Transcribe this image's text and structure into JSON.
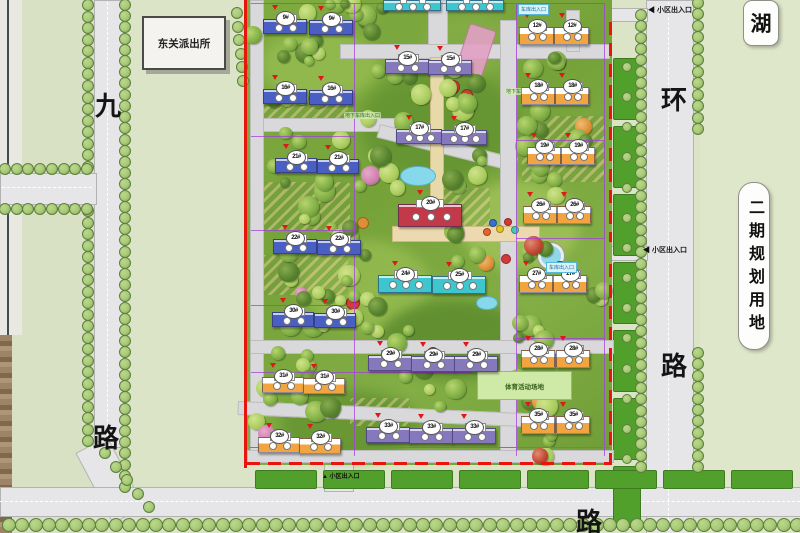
{
  "map_labels": {
    "police_station": "东关派出所",
    "lake": "湖",
    "phase2_vertical": "二期规划用地",
    "road_left_top": "九",
    "road_left_bottom": "路",
    "road_right_top": "环",
    "road_right_bottom": "路",
    "road_bottom": "路",
    "sports_field": "体育活动场地",
    "garage_entrance": "车库出入口",
    "underground_garage": "地下车库出入口",
    "community_entrance": "小区出入口"
  },
  "entrances": [
    {
      "x": 648,
      "y": 5,
      "arrow": "◀"
    },
    {
      "x": 643,
      "y": 245,
      "arrow": "◀"
    },
    {
      "x": 322,
      "y": 471,
      "arrow": "▲"
    }
  ],
  "garage_labels": [
    {
      "x": 518,
      "y": 4
    },
    {
      "x": 546,
      "y": 262
    }
  ],
  "underground_labels": [
    {
      "x": 344,
      "y": 112
    },
    {
      "x": 505,
      "y": 88
    }
  ],
  "buildings": [
    {
      "label": "9#",
      "color": "blue",
      "x": 263,
      "y": 19,
      "w": 42,
      "h": 13
    },
    {
      "label": "9#",
      "color": "blue",
      "x": 309,
      "y": 20,
      "w": 42,
      "h": 13
    },
    {
      "label": "16#",
      "color": "blue",
      "x": 263,
      "y": 89,
      "w": 42,
      "h": 13
    },
    {
      "label": "16#",
      "color": "blue",
      "x": 309,
      "y": 90,
      "w": 42,
      "h": 13
    },
    {
      "label": "21#",
      "color": "blue",
      "x": 275,
      "y": 158,
      "w": 40,
      "h": 13
    },
    {
      "label": "21#",
      "color": "blue",
      "x": 317,
      "y": 159,
      "w": 40,
      "h": 13
    },
    {
      "label": "22#",
      "color": "blue",
      "x": 273,
      "y": 239,
      "w": 42,
      "h": 13
    },
    {
      "label": "22#",
      "color": "blue",
      "x": 317,
      "y": 240,
      "w": 42,
      "h": 13
    },
    {
      "label": "30#",
      "color": "blue",
      "x": 272,
      "y": 312,
      "w": 40,
      "h": 13
    },
    {
      "label": "30#",
      "color": "blue",
      "x": 314,
      "y": 313,
      "w": 40,
      "h": 13
    },
    {
      "label": "31#",
      "color": "orange",
      "x": 262,
      "y": 377,
      "w": 40,
      "h": 14
    },
    {
      "label": "31#",
      "color": "orange",
      "x": 303,
      "y": 378,
      "w": 40,
      "h": 14
    },
    {
      "label": "32#",
      "color": "orange",
      "x": 258,
      "y": 437,
      "w": 40,
      "h": 14
    },
    {
      "label": "32#",
      "color": "orange",
      "x": 299,
      "y": 438,
      "w": 40,
      "h": 14
    },
    {
      "label": "15#",
      "color": "purple",
      "x": 385,
      "y": 59,
      "w": 42,
      "h": 13
    },
    {
      "label": "15#",
      "color": "purple",
      "x": 428,
      "y": 60,
      "w": 42,
      "h": 13
    },
    {
      "label": "17#",
      "color": "purple",
      "x": 396,
      "y": 129,
      "w": 44,
      "h": 13
    },
    {
      "label": "17#",
      "color": "purple",
      "x": 441,
      "y": 130,
      "w": 44,
      "h": 13
    },
    {
      "label": "",
      "color": "cyan",
      "x": 383,
      "y": 0,
      "w": 56,
      "h": 9
    },
    {
      "label": "",
      "color": "cyan",
      "x": 446,
      "y": 0,
      "w": 56,
      "h": 9
    },
    {
      "label": "20#",
      "color": "red",
      "x": 398,
      "y": 204,
      "w": 62,
      "h": 21
    },
    {
      "label": "24#",
      "color": "cyan",
      "x": 378,
      "y": 275,
      "w": 52,
      "h": 16
    },
    {
      "label": "25#",
      "color": "cyan",
      "x": 432,
      "y": 276,
      "w": 52,
      "h": 16
    },
    {
      "label": "29#",
      "color": "purple",
      "x": 368,
      "y": 355,
      "w": 42,
      "h": 14
    },
    {
      "label": "29#",
      "color": "purple",
      "x": 411,
      "y": 356,
      "w": 42,
      "h": 14
    },
    {
      "label": "29#",
      "color": "purple",
      "x": 454,
      "y": 356,
      "w": 42,
      "h": 14
    },
    {
      "label": "33#",
      "color": "purple",
      "x": 366,
      "y": 427,
      "w": 42,
      "h": 14
    },
    {
      "label": "33#",
      "color": "purple",
      "x": 409,
      "y": 428,
      "w": 42,
      "h": 14
    },
    {
      "label": "33#",
      "color": "purple",
      "x": 452,
      "y": 428,
      "w": 42,
      "h": 14
    },
    {
      "label": "12#",
      "color": "orange",
      "x": 519,
      "y": 27,
      "w": 33,
      "h": 16
    },
    {
      "label": "12#",
      "color": "orange",
      "x": 554,
      "y": 27,
      "w": 33,
      "h": 16
    },
    {
      "label": "18#",
      "color": "orange",
      "x": 521,
      "y": 87,
      "w": 32,
      "h": 16
    },
    {
      "label": "18#",
      "color": "orange",
      "x": 555,
      "y": 87,
      "w": 32,
      "h": 16
    },
    {
      "label": "19#",
      "color": "orange",
      "x": 527,
      "y": 147,
      "w": 32,
      "h": 16
    },
    {
      "label": "19#",
      "color": "orange",
      "x": 561,
      "y": 147,
      "w": 32,
      "h": 16
    },
    {
      "label": "26#",
      "color": "orange",
      "x": 523,
      "y": 206,
      "w": 32,
      "h": 16
    },
    {
      "label": "26#",
      "color": "orange",
      "x": 557,
      "y": 206,
      "w": 32,
      "h": 16
    },
    {
      "label": "27#",
      "color": "orange",
      "x": 519,
      "y": 275,
      "w": 32,
      "h": 16
    },
    {
      "label": "27#",
      "color": "orange",
      "x": 553,
      "y": 275,
      "w": 32,
      "h": 16
    },
    {
      "label": "28#",
      "color": "orange",
      "x": 521,
      "y": 350,
      "w": 32,
      "h": 16
    },
    {
      "label": "28#",
      "color": "orange",
      "x": 556,
      "y": 350,
      "w": 32,
      "h": 16
    },
    {
      "label": "35#",
      "color": "orange",
      "x": 521,
      "y": 416,
      "w": 32,
      "h": 16
    },
    {
      "label": "35#",
      "color": "orange",
      "x": 556,
      "y": 416,
      "w": 32,
      "h": 16
    }
  ],
  "colors": {
    "blue": "#4a5fc4",
    "purple": "#8678bd",
    "cyan": "#3ec6cf",
    "orange": "#f2a440",
    "red": "#c23a4a",
    "boundary_red": "#e8150f",
    "parcel_purple": "#a33de0"
  }
}
